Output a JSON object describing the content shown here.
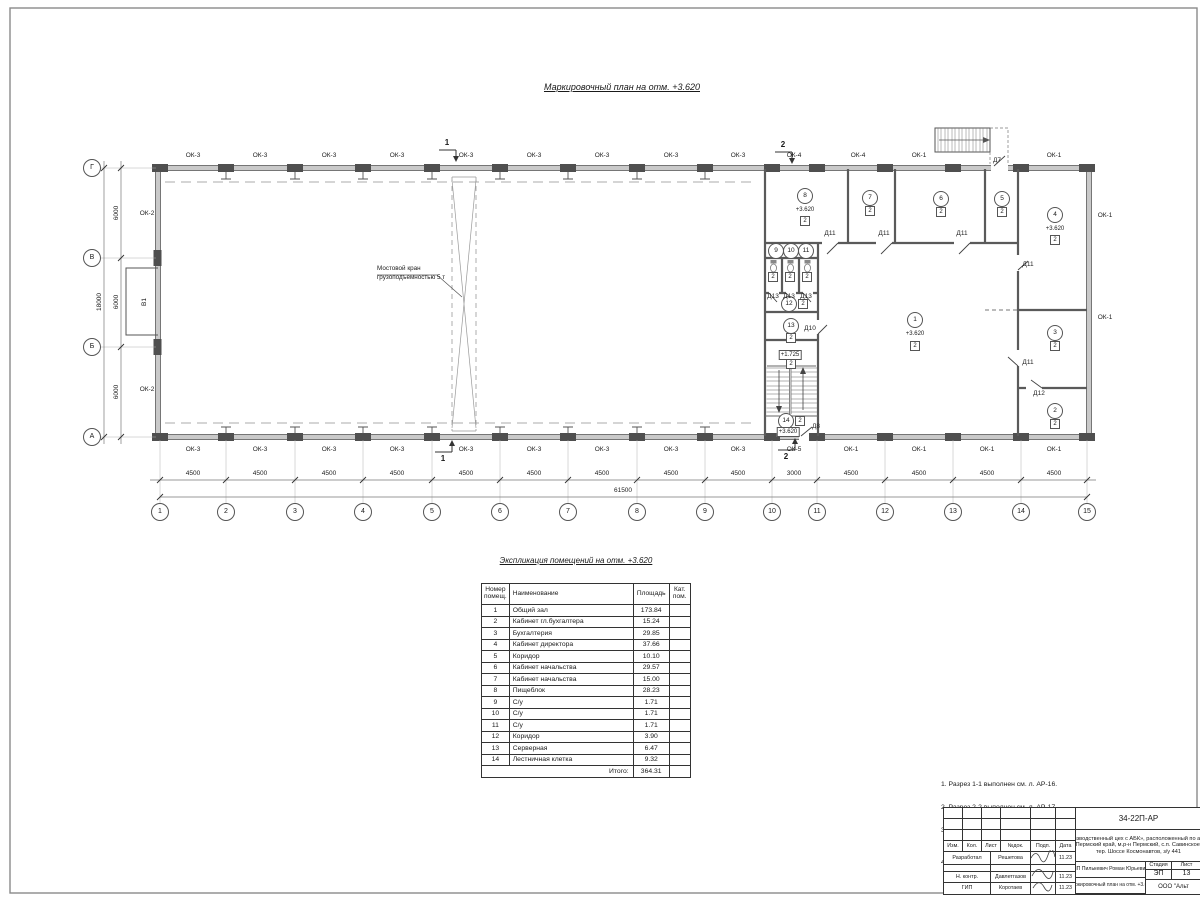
{
  "titles": {
    "plan": "Маркировочный план  на отм. +3.620",
    "table": "Экспликация помещений на отм. +3.620"
  },
  "plan": {
    "crane_note": "Мостовой кран\nгрузоподъемностью 5 т",
    "labels": [
      {
        "t": "ОК-3",
        "x": 193,
        "y": 156,
        "c": "lbl"
      },
      {
        "t": "ОК-3",
        "x": 260,
        "y": 156,
        "c": "lbl"
      },
      {
        "t": "ОК-3",
        "x": 329,
        "y": 156,
        "c": "lbl"
      },
      {
        "t": "ОК-3",
        "x": 397,
        "y": 156,
        "c": "lbl"
      },
      {
        "t": "ОК-3",
        "x": 466,
        "y": 156,
        "c": "lbl"
      },
      {
        "t": "ОК-3",
        "x": 534,
        "y": 156,
        "c": "lbl"
      },
      {
        "t": "ОК-3",
        "x": 602,
        "y": 156,
        "c": "lbl"
      },
      {
        "t": "ОК-3",
        "x": 671,
        "y": 156,
        "c": "lbl"
      },
      {
        "t": "ОК-3",
        "x": 738,
        "y": 156,
        "c": "lbl"
      },
      {
        "t": "ОК-4",
        "x": 794,
        "y": 156,
        "c": "lbl"
      },
      {
        "t": "ОК-4",
        "x": 858,
        "y": 156,
        "c": "lbl"
      },
      {
        "t": "ОК-1",
        "x": 919,
        "y": 156,
        "c": "lbl"
      },
      {
        "t": "ОК-1",
        "x": 1054,
        "y": 156,
        "c": "lbl"
      },
      {
        "t": "ОК-3",
        "x": 193,
        "y": 450,
        "c": "lbl"
      },
      {
        "t": "ОК-3",
        "x": 260,
        "y": 450,
        "c": "lbl"
      },
      {
        "t": "ОК-3",
        "x": 329,
        "y": 450,
        "c": "lbl"
      },
      {
        "t": "ОК-3",
        "x": 397,
        "y": 450,
        "c": "lbl"
      },
      {
        "t": "ОК-3",
        "x": 466,
        "y": 450,
        "c": "lbl"
      },
      {
        "t": "ОК-3",
        "x": 534,
        "y": 450,
        "c": "lbl"
      },
      {
        "t": "ОК-3",
        "x": 602,
        "y": 450,
        "c": "lbl"
      },
      {
        "t": "ОК-3",
        "x": 671,
        "y": 450,
        "c": "lbl"
      },
      {
        "t": "ОК-3",
        "x": 738,
        "y": 450,
        "c": "lbl"
      },
      {
        "t": "ОК-5",
        "x": 794,
        "y": 450,
        "c": "lbl"
      },
      {
        "t": "ОК-1",
        "x": 851,
        "y": 450,
        "c": "lbl"
      },
      {
        "t": "ОК-1",
        "x": 919,
        "y": 450,
        "c": "lbl"
      },
      {
        "t": "ОК-1",
        "x": 987,
        "y": 450,
        "c": "lbl"
      },
      {
        "t": "ОК-1",
        "x": 1054,
        "y": 450,
        "c": "lbl"
      },
      {
        "t": "ОК-2",
        "x": 147,
        "y": 214,
        "c": "lbl"
      },
      {
        "t": "ОК-2",
        "x": 147,
        "y": 390,
        "c": "lbl"
      },
      {
        "t": "ОК-1",
        "x": 1105,
        "y": 216,
        "c": "lbl"
      },
      {
        "t": "ОК-1",
        "x": 1105,
        "y": 318,
        "c": "lbl"
      },
      {
        "t": "В1",
        "x": 145,
        "y": 302,
        "c": "vlbl"
      },
      {
        "t": "1",
        "x": 160,
        "y": 512,
        "c": "gb"
      },
      {
        "t": "2",
        "x": 226,
        "y": 512,
        "c": "gb"
      },
      {
        "t": "3",
        "x": 295,
        "y": 512,
        "c": "gb"
      },
      {
        "t": "4",
        "x": 363,
        "y": 512,
        "c": "gb"
      },
      {
        "t": "5",
        "x": 432,
        "y": 512,
        "c": "gb"
      },
      {
        "t": "6",
        "x": 500,
        "y": 512,
        "c": "gb"
      },
      {
        "t": "7",
        "x": 568,
        "y": 512,
        "c": "gb"
      },
      {
        "t": "8",
        "x": 637,
        "y": 512,
        "c": "gb"
      },
      {
        "t": "9",
        "x": 705,
        "y": 512,
        "c": "gb"
      },
      {
        "t": "10",
        "x": 772,
        "y": 512,
        "c": "gb"
      },
      {
        "t": "11",
        "x": 817,
        "y": 512,
        "c": "gb"
      },
      {
        "t": "12",
        "x": 885,
        "y": 512,
        "c": "gb"
      },
      {
        "t": "13",
        "x": 953,
        "y": 512,
        "c": "gb"
      },
      {
        "t": "14",
        "x": 1021,
        "y": 512,
        "c": "gb"
      },
      {
        "t": "15",
        "x": 1087,
        "y": 512,
        "c": "gb"
      },
      {
        "t": "Г",
        "x": 92,
        "y": 168,
        "c": "gb"
      },
      {
        "t": "В",
        "x": 92,
        "y": 258,
        "c": "gb"
      },
      {
        "t": "Б",
        "x": 92,
        "y": 347,
        "c": "gb"
      },
      {
        "t": "А",
        "x": 92,
        "y": 437,
        "c": "gb"
      },
      {
        "t": "4500",
        "x": 193,
        "y": 474,
        "c": "dim"
      },
      {
        "t": "4500",
        "x": 260,
        "y": 474,
        "c": "dim"
      },
      {
        "t": "4500",
        "x": 329,
        "y": 474,
        "c": "dim"
      },
      {
        "t": "4500",
        "x": 397,
        "y": 474,
        "c": "dim"
      },
      {
        "t": "4500",
        "x": 466,
        "y": 474,
        "c": "dim"
      },
      {
        "t": "4500",
        "x": 534,
        "y": 474,
        "c": "dim"
      },
      {
        "t": "4500",
        "x": 602,
        "y": 474,
        "c": "dim"
      },
      {
        "t": "4500",
        "x": 671,
        "y": 474,
        "c": "dim"
      },
      {
        "t": "4500",
        "x": 738,
        "y": 474,
        "c": "dim"
      },
      {
        "t": "3000",
        "x": 794,
        "y": 474,
        "c": "dim"
      },
      {
        "t": "4500",
        "x": 851,
        "y": 474,
        "c": "dim"
      },
      {
        "t": "4500",
        "x": 919,
        "y": 474,
        "c": "dim"
      },
      {
        "t": "4500",
        "x": 987,
        "y": 474,
        "c": "dim"
      },
      {
        "t": "4500",
        "x": 1054,
        "y": 474,
        "c": "dim"
      },
      {
        "t": "61500",
        "x": 623,
        "y": 491,
        "c": "dim"
      },
      {
        "t": "6000",
        "x": 117,
        "y": 213,
        "c": "vdim"
      },
      {
        "t": "6000",
        "x": 117,
        "y": 302,
        "c": "vdim"
      },
      {
        "t": "6000",
        "x": 117,
        "y": 392,
        "c": "vdim"
      },
      {
        "t": "18000",
        "x": 100,
        "y": 302,
        "c": "vdim"
      },
      {
        "t": "1",
        "x": 915,
        "y": 320,
        "c": "rb"
      },
      {
        "t": "+3.620",
        "x": 915,
        "y": 334,
        "c": "el"
      },
      {
        "t": "2",
        "x": 915,
        "y": 346,
        "c": "sq"
      },
      {
        "t": "2",
        "x": 1055,
        "y": 411,
        "c": "rb"
      },
      {
        "t": "2",
        "x": 1055,
        "y": 424,
        "c": "sq"
      },
      {
        "t": "3",
        "x": 1055,
        "y": 333,
        "c": "rb"
      },
      {
        "t": "2",
        "x": 1055,
        "y": 346,
        "c": "sq"
      },
      {
        "t": "4",
        "x": 1055,
        "y": 215,
        "c": "rb"
      },
      {
        "t": "+3.620",
        "x": 1055,
        "y": 229,
        "c": "el"
      },
      {
        "t": "2",
        "x": 1055,
        "y": 240,
        "c": "sq"
      },
      {
        "t": "5",
        "x": 1002,
        "y": 199,
        "c": "rb"
      },
      {
        "t": "2",
        "x": 1002,
        "y": 212,
        "c": "sq"
      },
      {
        "t": "6",
        "x": 941,
        "y": 199,
        "c": "rb"
      },
      {
        "t": "2",
        "x": 941,
        "y": 212,
        "c": "sq"
      },
      {
        "t": "7",
        "x": 870,
        "y": 198,
        "c": "rb"
      },
      {
        "t": "2",
        "x": 870,
        "y": 211,
        "c": "sq"
      },
      {
        "t": "8",
        "x": 805,
        "y": 196,
        "c": "rb"
      },
      {
        "t": "+3.620",
        "x": 805,
        "y": 210,
        "c": "el"
      },
      {
        "t": "2",
        "x": 805,
        "y": 221,
        "c": "sq"
      },
      {
        "t": "9",
        "x": 776,
        "y": 251,
        "c": "rb"
      },
      {
        "t": "10",
        "x": 791,
        "y": 251,
        "c": "rb"
      },
      {
        "t": "11",
        "x": 806,
        "y": 251,
        "c": "rb"
      },
      {
        "t": "2",
        "x": 773,
        "y": 277,
        "c": "sq"
      },
      {
        "t": "2",
        "x": 790,
        "y": 277,
        "c": "sq"
      },
      {
        "t": "2",
        "x": 807,
        "y": 277,
        "c": "sq"
      },
      {
        "t": "12",
        "x": 789,
        "y": 304,
        "c": "rb"
      },
      {
        "t": "2",
        "x": 803,
        "y": 304,
        "c": "sq"
      },
      {
        "t": "13",
        "x": 791,
        "y": 326,
        "c": "rb"
      },
      {
        "t": "2",
        "x": 791,
        "y": 338,
        "c": "sq"
      },
      {
        "t": "+1.725",
        "x": 790,
        "y": 355,
        "c": "elb"
      },
      {
        "t": "2",
        "x": 791,
        "y": 364,
        "c": "sq"
      },
      {
        "t": "14",
        "x": 786,
        "y": 421,
        "c": "rb"
      },
      {
        "t": "2",
        "x": 800,
        "y": 421,
        "c": "sq"
      },
      {
        "t": "+3.620",
        "x": 788,
        "y": 432,
        "c": "elb"
      },
      {
        "t": "Д7",
        "x": 997,
        "y": 161,
        "c": "lbl"
      },
      {
        "t": "Д11",
        "x": 830,
        "y": 234,
        "c": "lbl"
      },
      {
        "t": "Д11",
        "x": 884,
        "y": 234,
        "c": "lbl"
      },
      {
        "t": "Д11",
        "x": 962,
        "y": 234,
        "c": "lbl"
      },
      {
        "t": "Д11",
        "x": 1028,
        "y": 265,
        "c": "lbl"
      },
      {
        "t": "Д11",
        "x": 1028,
        "y": 363,
        "c": "lbl"
      },
      {
        "t": "Д12",
        "x": 1039,
        "y": 394,
        "c": "lbl"
      },
      {
        "t": "Д13",
        "x": 773,
        "y": 297,
        "c": "lbl"
      },
      {
        "t": "Д13",
        "x": 789,
        "y": 297,
        "c": "lbl"
      },
      {
        "t": "Д13",
        "x": 806,
        "y": 297,
        "c": "lbl"
      },
      {
        "t": "Д10",
        "x": 810,
        "y": 329,
        "c": "lbl"
      },
      {
        "t": "Д8",
        "x": 816,
        "y": 427,
        "c": "lbl"
      },
      {
        "t": "1",
        "x": 447,
        "y": 143,
        "c": "sec"
      },
      {
        "t": "1",
        "x": 443,
        "y": 459,
        "c": "sec"
      },
      {
        "t": "2",
        "x": 783,
        "y": 145,
        "c": "sec"
      },
      {
        "t": "2",
        "x": 786,
        "y": 457,
        "c": "sec"
      }
    ]
  },
  "table": {
    "headers": [
      "Номер\nпомещ.",
      "Наименование",
      "Площадь",
      "Кат.\nпом."
    ],
    "rows": [
      [
        "1",
        "Общий зал",
        "173.84"
      ],
      [
        "2",
        "Кабинет гл.бухгалтера",
        "15.24"
      ],
      [
        "3",
        "Бухгалтерия",
        "29.85"
      ],
      [
        "4",
        "Кабинет директора",
        "37.66"
      ],
      [
        "5",
        "Коридор",
        "10.10"
      ],
      [
        "6",
        "Кабинет начальства",
        "29.57"
      ],
      [
        "7",
        "Кабинет начальства",
        "15.00"
      ],
      [
        "8",
        "Пищеблок",
        "28.23"
      ],
      [
        "9",
        "С/у",
        "1.71"
      ],
      [
        "10",
        "С/у",
        "1.71"
      ],
      [
        "11",
        "С/у",
        "1.71"
      ],
      [
        "12",
        "Коридор",
        "3.90"
      ],
      [
        "13",
        "Серверная",
        "6.47"
      ],
      [
        "14",
        "Лестничная клетка",
        "9.32"
      ]
    ],
    "total_label": "Итого:",
    "total_value": "364.31"
  },
  "notes": [
    "1. Разрез 1-1 выполнен см. л. АР-16.",
    "2. Разрез 2-2 выполнен см. л. АР-17.",
    "3. Спецификация заполнения оконных и дверных\n    проемов выполнена см. л. АР-18.",
    "4. Экспликация полов выполнена см. л. АР-18."
  ],
  "stamp": {
    "code": "34-22П-АР",
    "cols": [
      "Изм.",
      "Кол.",
      "Лист",
      "№док.",
      "Подп.",
      "Дата"
    ],
    "people": [
      {
        "role": "Разработал",
        "name": "Решетова",
        "date": "11.23"
      },
      {
        "role": "Н. контр.",
        "name": "Давлетгазов",
        "date": "11.23"
      },
      {
        "role": "ГИП",
        "name": "Коротаев",
        "date": "11.23"
      }
    ],
    "project_lines": [
      "«Производственный цех с АБК», расположенный по адресу:",
      "Пермский край, м.р-н Пермский, с.п. Савинское,",
      "тер. Шоссе Космонавтов, з/у 441"
    ],
    "client": "ИП Пилькевич Роман Юрьевич",
    "stage_label": "Стадия",
    "sheet_label": "Лист",
    "stage": "ЭП",
    "sheet": "13",
    "sheet_title": "Маркировочный план на отм. +3.620",
    "company": "ООО \"Альт"
  }
}
